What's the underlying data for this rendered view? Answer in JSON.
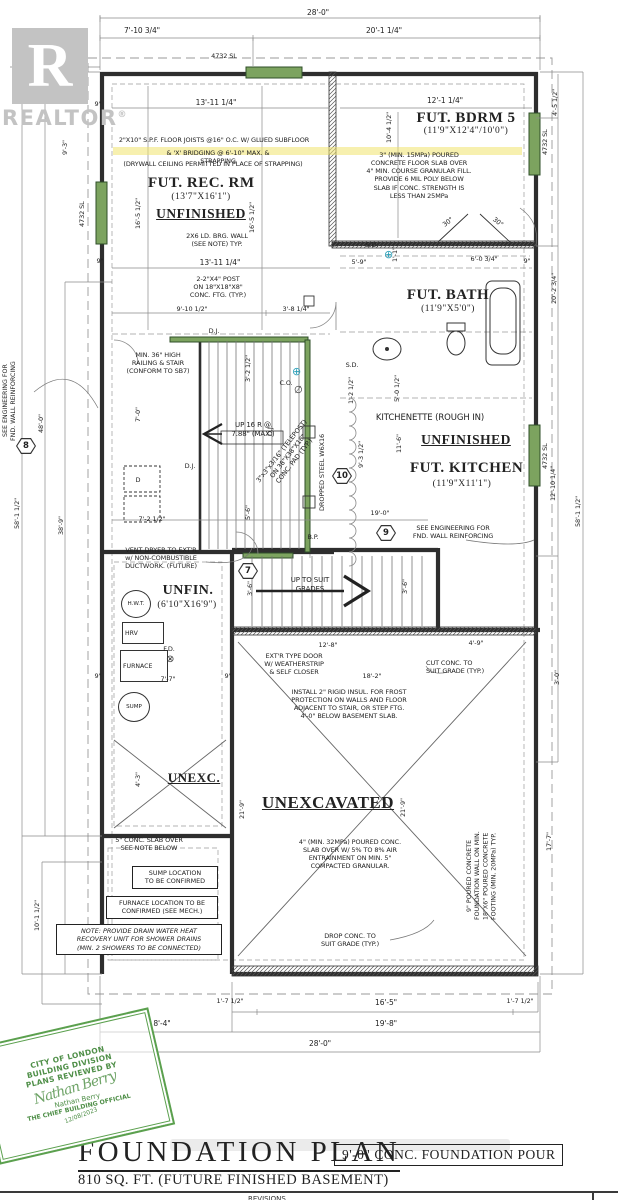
{
  "logo": {
    "letter": "R",
    "brand": "REALTOR",
    "reg": "®"
  },
  "rooms": {
    "rec": {
      "title": "FUT. REC. RM",
      "size": "(13'7\"X16'1\")",
      "status": "UNFINISHED"
    },
    "bdrm": {
      "title": "FUT. BDRM 5",
      "size": "(11'9\"X12'4\"/10'0\")"
    },
    "bath": {
      "title": "FUT. BATH",
      "size": "(11'9\"X5'0\")"
    },
    "kitchen": {
      "rough": "KITCHENETTE (ROUGH IN)",
      "status": "UNFINISHED",
      "title": "FUT. KITCHEN",
      "size": "(11'9\"X11'1\")"
    },
    "mech": {
      "title": "UNFIN.",
      "size": "(6'10\"X16'9\")"
    },
    "unexc_small": "UNEXC.",
    "unexc_large": "UNEXCAVATED"
  },
  "equipment": {
    "hwt": "H.W.T.",
    "hrv": "HRV",
    "furnace": "FURNACE",
    "sump": "SUMP",
    "fd": "F.D.",
    "dryer": "D"
  },
  "annotations": {
    "joists": "2\"X10\" S.P.F. FLOOR JOISTS @16\" O.C. W/ GLUED SUBFLOOR",
    "bridging": "& 'X' BRIDGING @ 6'-10\" MAX. & STRAPPING",
    "drywall": "(DRYWALL CEILING PERMITTED IN PLACE OF STRAPPING)",
    "brg_wall": "2X6 LD. BRG. WALL\n(SEE NOTE) TYP.",
    "post": "2-2\"X4\" POST\nON 18\"X18\"X8\"\nCONC. FTG. (TYP.)",
    "slab3": "3\" (MIN. 15MPa) POURED\nCONCRETE FLOOR SLAB OVER\n4\" MIN. COURSE GRANULAR FILL.\nPROVIDE 6 MIL POLY BELOW\nSLAB IF CONC. STRENGTH IS\nLESS THAN 25MPa",
    "railing": "MIN. 36\" HIGH\nRAILING & STAIR\n(CONFORM TO SB7)",
    "up16": "UP 16 R @\n7.88\" (MAX.)",
    "telepost": "3\"x3\"x3/16\" (TELEPOST)\nON 38\"X38\"X18\"\nCONC. PAD (TYP.)",
    "dropped_steel": "DROPPED STEEL W6X16",
    "eng": "SEE ENGINEERING FOR\nFND. WALL REINFORCING",
    "vent": "VENT DRYER TO EXT'R\nw/ NON-COMBUSTIBLE\nDUCTWORK. (FUTURE)",
    "up_grades": "UP TO SUIT\nGRADES",
    "ext_door": "EXT'R TYPE DOOR\nW/ WEATHERSTRIP\n& SELF CLOSER",
    "rigid": "INSTALL 2\" RIGID INSUL. FOR FROST\nPROTECTION ON WALLS AND FLOOR\nADJACENT TO STAIR, OR STEP FTG.\n4'-0\" BELOW BASEMENT SLAB.",
    "cut_conc": "CUT CONC. TO\nSUIT GRADE (TYP.)",
    "slab5": "5\" CONC. SLAB OVER\nSEE NOTE BELOW",
    "slab4": "4\" (MIN. 32MPa) POURED CONC.\nSLAB OVER W/ 5% TO 8% AIR\nENTRAINMENT ON MIN. 5\"\nCOMPACTED GRANULAR.",
    "drop_conc": "DROP CONC. TO\nSUIT GRADE (TYP.)",
    "fnd_wall": "9\" POURED CONCRETE\nFOUNDATION WALL ON MIN.\n18\"X6\" POURED CONCRETE\nFOOTING (MIN. 20MPa) TYP.",
    "dj": "D.J.",
    "sd": "S.D.",
    "co": "C.O.",
    "bp": "B.P.",
    "window_code": "4732 SL"
  },
  "note_boxes": {
    "sump": "SUMP LOCATION\nTO BE CONFIRMED",
    "furnace": "FURNACE LOCATION TO BE\nCONFIRMED (SEE MECH.)",
    "dwhr": "NOTE: PROVIDE DRAIN WATER HEAT\nRECOVERY UNIT FOR SHOWER DRAINS\n(MIN. 2 SHOWERS TO BE CONNECTED)"
  },
  "dims": {
    "top_overall": "28'-0\"",
    "top_left": "7'-10 3/4\"",
    "top_right": "20'-1 1/4\"",
    "rec_w": "13'-11 1/4\"",
    "bdrm_w": "12'-1 1/4\"",
    "bdrm_h": "10'-4 1/2\"",
    "l9_3": "9'-3\"",
    "l16_5": "16'-5 1/2\"",
    "l58": "58'-1 1/2\"",
    "l46": "48'-0\"",
    "l38": "38'-9\"",
    "l7": "7'-0\"",
    "l10_1": "10'-1 1/2\"",
    "w9": "9\"",
    "d3_8": "3'-8 1/4\"",
    "d9_10": "9'-10 1/2\"",
    "d5_9": "5'-9\"",
    "d1_1": "1'-1\"",
    "d6_0": "6'-0 3/4\"",
    "ang": "30°",
    "d5_0": "5'-0 1/2\"",
    "d3_2": "3'-2 1/2\"",
    "d1_2": "1'-2 1/2\"",
    "r20_2": "20'-2 3/4\"",
    "r4_5": "4'-5 1/2\"",
    "r12_10": "12'-10 1/4\"",
    "r17_7": "17'-7\"",
    "r3_0": "3'-0\"",
    "d9_3h": "9'-3 1/2\"",
    "d11_6": "11'-6\"",
    "d19_0": "19'-0\"",
    "d12_8": "12'-8\"",
    "d4_9": "4'-9\"",
    "d18_2": "18'-2\"",
    "d3_6": "3'-6\"",
    "d7_7": "7'-7\"",
    "d7_2": "7'-2 1/2\"",
    "d4_3": "4'-3\"",
    "d5_6": "5'-6\"",
    "d21_9": "21'-9\"",
    "b1_7": "1'-7 1/2\"",
    "b16_5": "16'-5\"",
    "b19_8": "19'-8\"",
    "b8_4": "8'-4\""
  },
  "markers": {
    "m7": "7",
    "m8": "8",
    "m9": "9",
    "m10": "10"
  },
  "stamp": {
    "line1": "CITY OF LONDON",
    "line2": "BUILDING DIVISION",
    "line3": "PLANS REVIEWED BY",
    "signature": "Nathan Berry",
    "name": "Nathan Berry",
    "title": "THE CHIEF BUILDING OFFICIAL",
    "date": "12/08/2023"
  },
  "title_block": {
    "title": "FOUNDATION PLAN",
    "subtitle": "810 SQ. FT. (FUTURE FINISHED BASEMENT)",
    "pour": "9'-0\" CONC. FOUNDATION POUR",
    "revisions": "REVISIONS"
  }
}
